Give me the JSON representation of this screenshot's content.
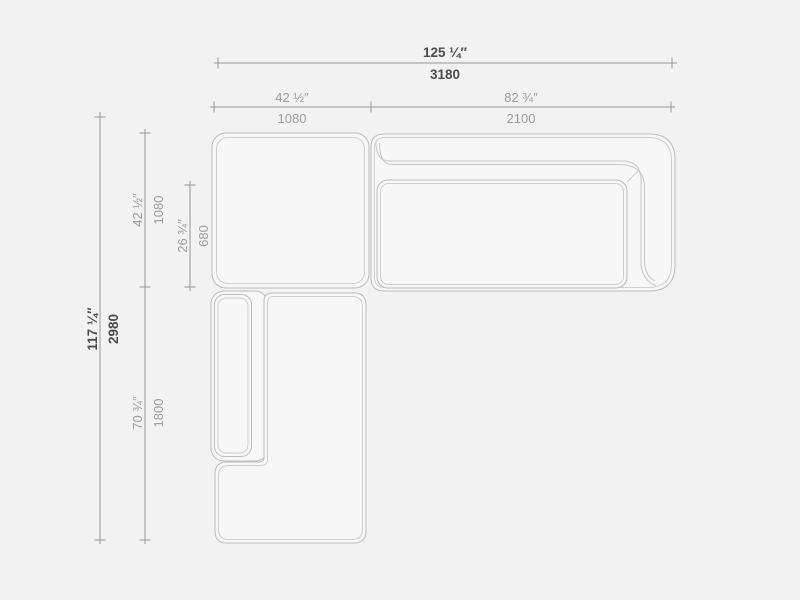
{
  "drawing": {
    "type": "furniture-dimension-diagram",
    "subject": "modular corner sofa, top view"
  },
  "colors": {
    "background": "#f2f2f2",
    "shape_fill": "#f7f7f7",
    "outline": "#bcbcbc",
    "inner_line": "#cfcfcf",
    "dimension_line": "#979797",
    "label_regular": "#9d9d9d",
    "label_bold": "#4b4b4b"
  },
  "dims": {
    "total_width": {
      "in": "125 ¼″",
      "mm": "3180"
    },
    "left_width": {
      "in": "42 ½″",
      "mm": "1080"
    },
    "right_width": {
      "in": "82 ¾″",
      "mm": "2100"
    },
    "total_depth": {
      "in": "117 ¼″",
      "mm": "2980"
    },
    "top_depth": {
      "in": "42 ½″",
      "mm": "1080"
    },
    "seat_depth": {
      "in": "26 ¾″",
      "mm": "680"
    },
    "chaise_length": {
      "in": "70 ¾″",
      "mm": "1800"
    }
  }
}
